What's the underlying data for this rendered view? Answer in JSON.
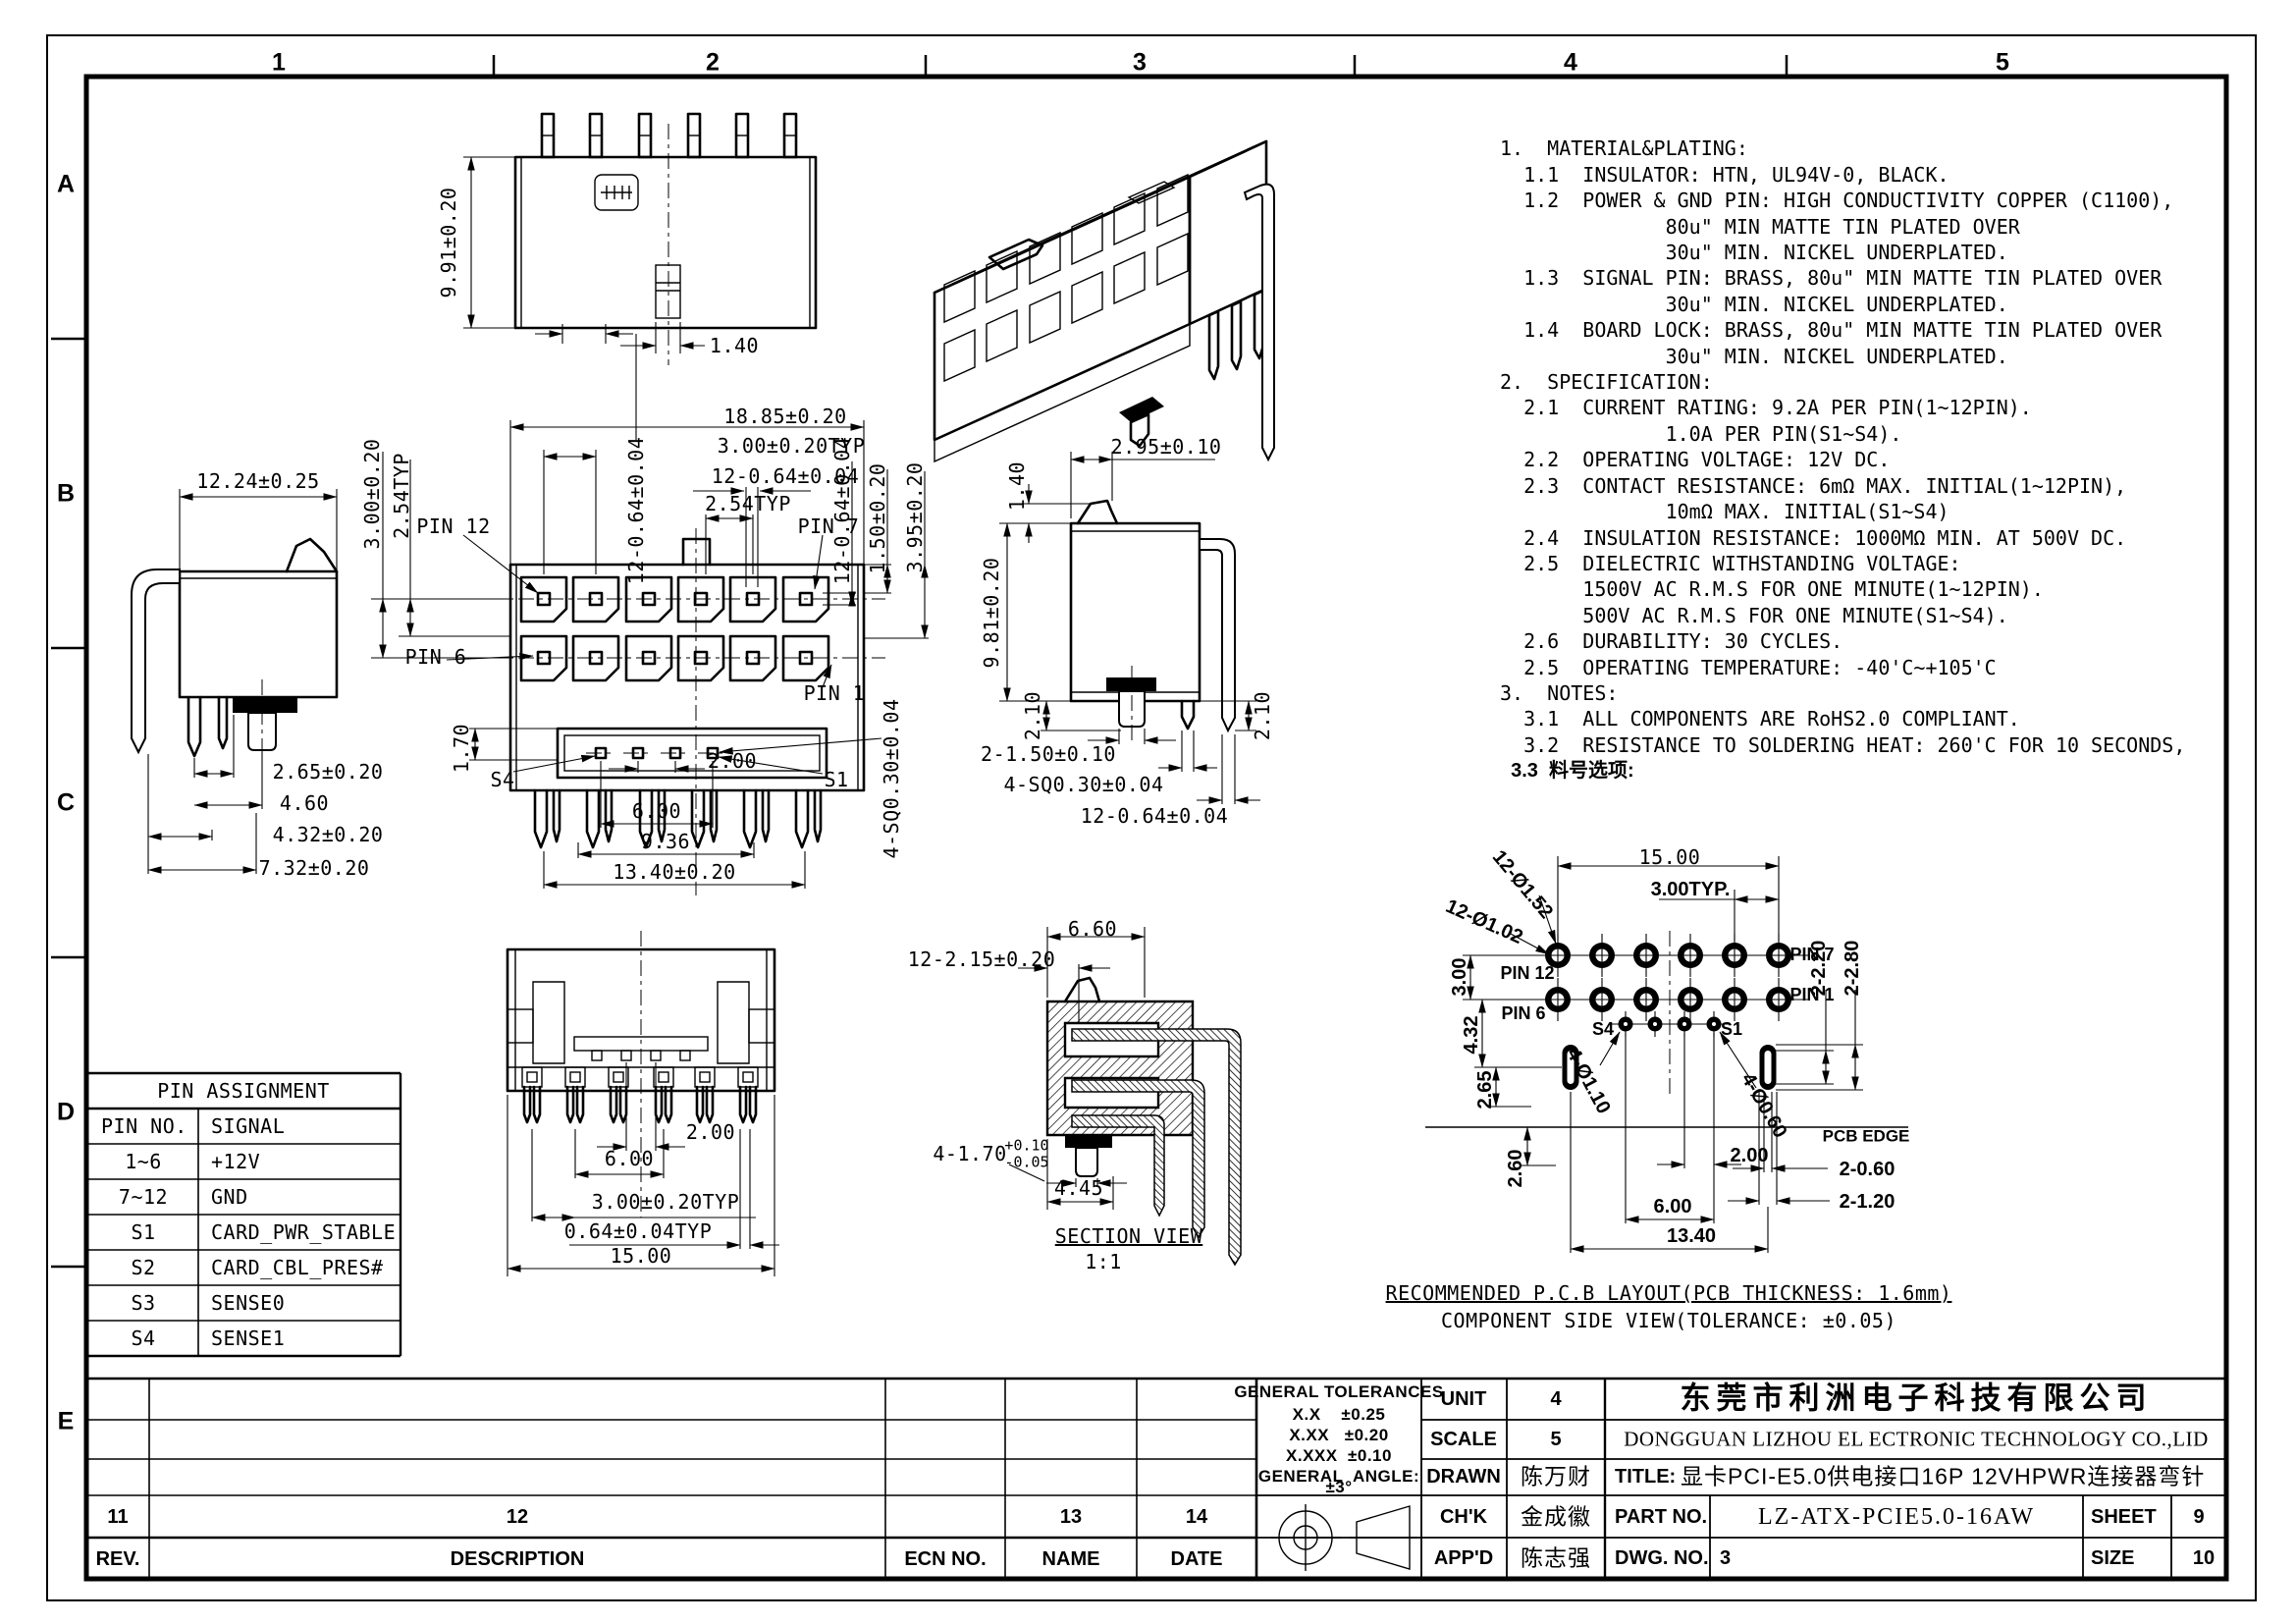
{
  "sheet": {
    "zones_top": [
      "1",
      "2",
      "3",
      "4",
      "5"
    ],
    "zones_left": [
      "A",
      "B",
      "C",
      "D",
      "E"
    ]
  },
  "notes": {
    "lines": [
      "1.  MATERIAL&PLATING:",
      "  1.1  INSULATOR: HTN, UL94V-0, BLACK.",
      "  1.2  POWER & GND PIN: HIGH CONDUCTIVITY COPPER (C1100),",
      "              80u\" MIN MATTE TIN PLATED OVER",
      "              30u\" MIN. NICKEL UNDERPLATED.",
      "  1.3  SIGNAL PIN: BRASS, 80u\" MIN MATTE TIN PLATED OVER",
      "              30u\" MIN. NICKEL UNDERPLATED.",
      "  1.4  BOARD LOCK: BRASS, 80u\" MIN MATTE TIN PLATED OVER",
      "              30u\" MIN. NICKEL UNDERPLATED.",
      "2.  SPECIFICATION:",
      "  2.1  CURRENT RATING: 9.2A PER PIN(1~12PIN).",
      "              1.0A PER PIN(S1~S4).",
      "  2.2  OPERATING VOLTAGE: 12V DC.",
      "  2.3  CONTACT RESISTANCE: 6mΩ MAX. INITIAL(1~12PIN),",
      "              10mΩ MAX. INITIAL(S1~S4)",
      "  2.4  INSULATION RESISTANCE: 1000MΩ MIN. AT 500V DC.",
      "  2.5  DIELECTRIC WITHSTANDING VOLTAGE:",
      "       1500V AC R.M.S FOR ONE MINUTE(1~12PIN).",
      "       500V AC R.M.S FOR ONE MINUTE(S1~S4).",
      "  2.6  DURABILITY: 30 CYCLES.",
      "  2.5  OPERATING TEMPERATURE: -40'C~+105'C",
      "3.  NOTES:",
      "  3.1  ALL COMPONENTS ARE RoHS2.0 COMPLIANT.",
      "  3.2  RESISTANCE TO SOLDERING HEAT: 260'C FOR 10 SECONDS,",
      "  3.3  料号选项:"
    ]
  },
  "views": {
    "top_view": {
      "height": "9.91±0.20",
      "key": "1.40"
    },
    "front_view": {
      "width": "18.85±0.20",
      "pitch": "3.00±0.20TYP",
      "pin_w": "12-0.64±0.04",
      "pitch2": "2.54TYP",
      "pin_w_v": "12-0.64±0.04",
      "row_pitch": "3.00±0.20",
      "row_pitch2": "2.54TYP",
      "pin12": "PIN 12",
      "pin7": "PIN 7",
      "pin6": "PIN 6",
      "pin1": "PIN 1",
      "s4": "S4",
      "s1": "S1",
      "d170": "1.70",
      "d200": "2.00",
      "d600": "6.00",
      "d936": "9.36",
      "d1340": "13.40±0.20",
      "d150": "1.50±0.20",
      "d395": "3.95±0.20",
      "pin_v2": "12-0.64±0.04",
      "sq": "4-SQ0.30±0.04"
    },
    "side_left": {
      "width": "12.24±0.25",
      "d265": "2.65±0.20",
      "d460": "4.60",
      "d432": "4.32±0.20",
      "d732": "7.32±0.20"
    },
    "side_right": {
      "latch_h": "1.40",
      "latch_w": "2.95±0.10",
      "height": "9.81±0.20",
      "d210l": "2.10",
      "d210r": "2.10",
      "peg": "2-1.50±0.10",
      "sq": "4-SQ0.30±0.04",
      "pin_w": "12-0.64±0.04"
    },
    "bottom_view": {
      "d200": "2.00",
      "d600": "6.00",
      "pitch": "3.00±0.20TYP",
      "pin": "0.64±0.04TYP",
      "width": "15.00"
    },
    "section_view": {
      "d660": "6.60",
      "d215": "12-2.15±0.20",
      "d170": "4-1.70",
      "tol_up": "+0.10",
      "tol_dn": "-0.05",
      "d445": "4.45",
      "caption": "SECTION VIEW",
      "scale": "1:1"
    },
    "pcb": {
      "w": "15.00",
      "pitch": "3.00TYP.",
      "hole_o": "12-Ø1.52",
      "hole_i": "12-Ø1.02",
      "row3": "3.00",
      "d432": "4.32",
      "d265": "2.65",
      "d260": "2.60",
      "pin12": "PIN 12",
      "pin6": "PIN 6",
      "pin7": "PIN 7",
      "pin1": "PIN 1",
      "s4": "S4",
      "s1": "S1",
      "s_hole": "4-Ø1.10",
      "s_hole2": "4-Ø0.60",
      "d220": "2-2.20",
      "d280": "2-2.80",
      "edge": "PCB EDGE",
      "d060": "2-0.60",
      "d120": "2-1.20",
      "d200": "2.00",
      "d600": "6.00",
      "d1340": "13.40",
      "cap1": "RECOMMENDED P.C.B LAYOUT(PCB THICKNESS: 1.6mm)",
      "cap2": "COMPONENT SIDE VIEW(TOLERANCE: ±0.05)"
    }
  },
  "pin_table": {
    "title": "PIN ASSIGNMENT",
    "col1": "PIN NO.",
    "col2": "SIGNAL",
    "rows": [
      {
        "no": "1~6",
        "signal": "+12V"
      },
      {
        "no": "7~12",
        "signal": "GND"
      },
      {
        "no": "S1",
        "signal": "CARD_PWR_STABLE"
      },
      {
        "no": "S2",
        "signal": "CARD_CBL_PRES#"
      },
      {
        "no": "S3",
        "signal": "SENSE0"
      },
      {
        "no": "S4",
        "signal": "SENSE1"
      }
    ]
  },
  "revision": {
    "zones": [
      "11",
      "12",
      "13",
      "14"
    ],
    "headers": [
      "REV.",
      "DESCRIPTION",
      "ECN NO.",
      "NAME",
      "DATE"
    ]
  },
  "title_block": {
    "tol_title": "GENERAL TOLERANCES",
    "tol_rows": [
      "X.X    ±0.25",
      "X.XX   ±0.20",
      "X.XXX  ±0.10",
      "GENERAL  ANGLE:",
      "±3°"
    ],
    "unit_label": "UNIT",
    "unit": "4",
    "scale_label": "SCALE",
    "scale": "5",
    "drawn_label": "DRAWN",
    "drawn": "陈万财",
    "chk_label": "CH'K",
    "chk": "金成徽",
    "appd_label": "APP'D",
    "appd": "陈志强",
    "company_cn": "东莞市利洲电子科技有限公司",
    "company_en": "DONGGUAN LIZHOU EL ECTRONIC TECHNOLOGY CO.,LID",
    "title_label": "TITLE:",
    "title": "显卡PCI-E5.0供电接口16P 12VHPWR连接器弯针",
    "part_label": "PART NO.",
    "part": "LZ-ATX-PCIE5.0-16AW",
    "sheet_label": "SHEET",
    "sheet": "9",
    "dwg_label": "DWG. NO.",
    "dwg": "3",
    "size_label": "SIZE",
    "size": "10"
  }
}
